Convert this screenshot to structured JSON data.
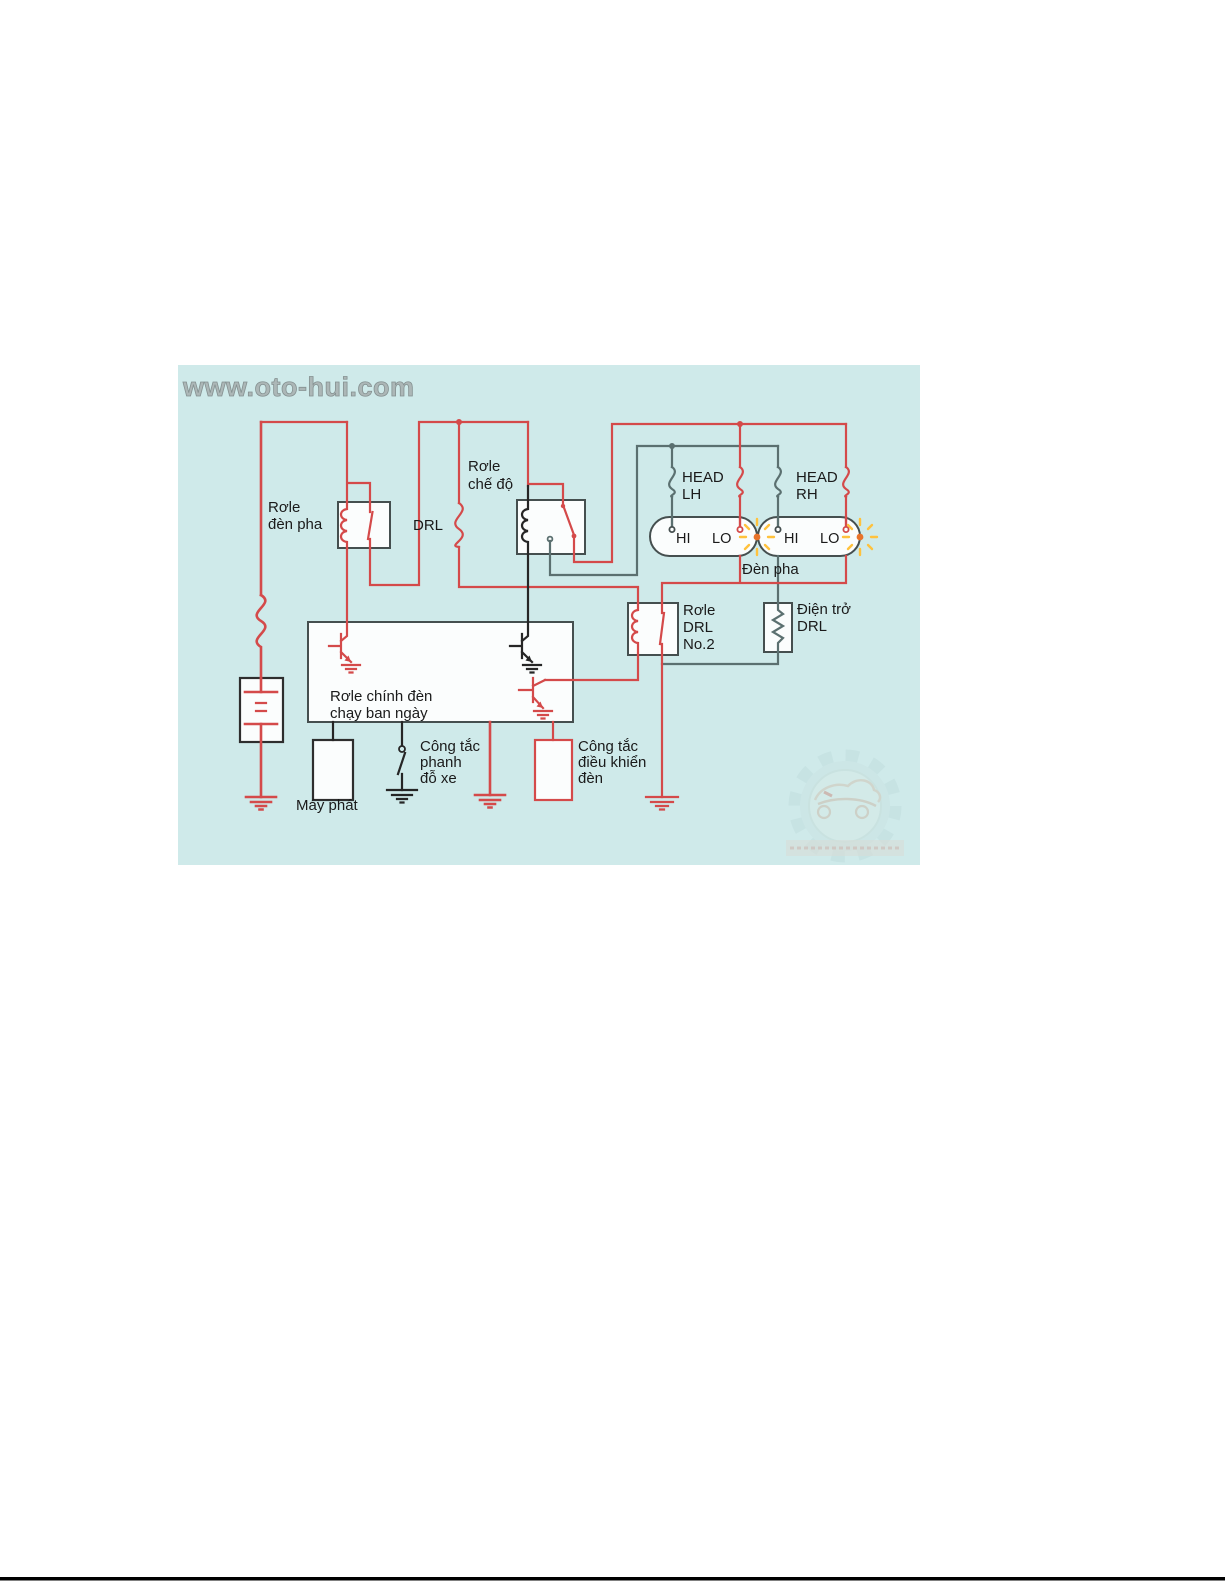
{
  "page": {
    "background_color": "#ffffff",
    "footer_rule_color": "#000000"
  },
  "diagram": {
    "background_color": "#cfeaea",
    "watermark": "www.oto-hui.com",
    "colors": {
      "wire_red": "#d44a4a",
      "wire_gray": "#5b7070",
      "wire_black": "#262626",
      "box_outline": "#454f4f",
      "box_fill": "#fbfdfd",
      "label_text": "#1a1a1a",
      "glow_yellow": "#ffc23d",
      "glow_orange": "#e8732a"
    },
    "labels": {
      "relay_headlamp": [
        "Rơle",
        "đèn pha"
      ],
      "fuse_drl": "DRL",
      "relay_mode": [
        "Rơle",
        "chế độ"
      ],
      "fuse_head_lh": [
        "HEAD",
        "LH"
      ],
      "fuse_head_rh": [
        "HEAD",
        "RH"
      ],
      "bulb_hi": "HI",
      "bulb_lo": "LO",
      "headlamps": "Đèn pha",
      "relay_drl_no2": [
        "Rơle",
        "DRL",
        "No.2"
      ],
      "resistor_drl": [
        "Điện trở",
        "DRL"
      ],
      "main_drl_relay": [
        "Rơle chính đèn",
        "chạy ban ngày"
      ],
      "alternator": "Máy phát",
      "parking_brake_switch": [
        "Công tắc",
        "phanh",
        "đỗ xe"
      ],
      "light_control_switch": [
        "Công tắc",
        "điều khiển",
        "đèn"
      ]
    }
  }
}
